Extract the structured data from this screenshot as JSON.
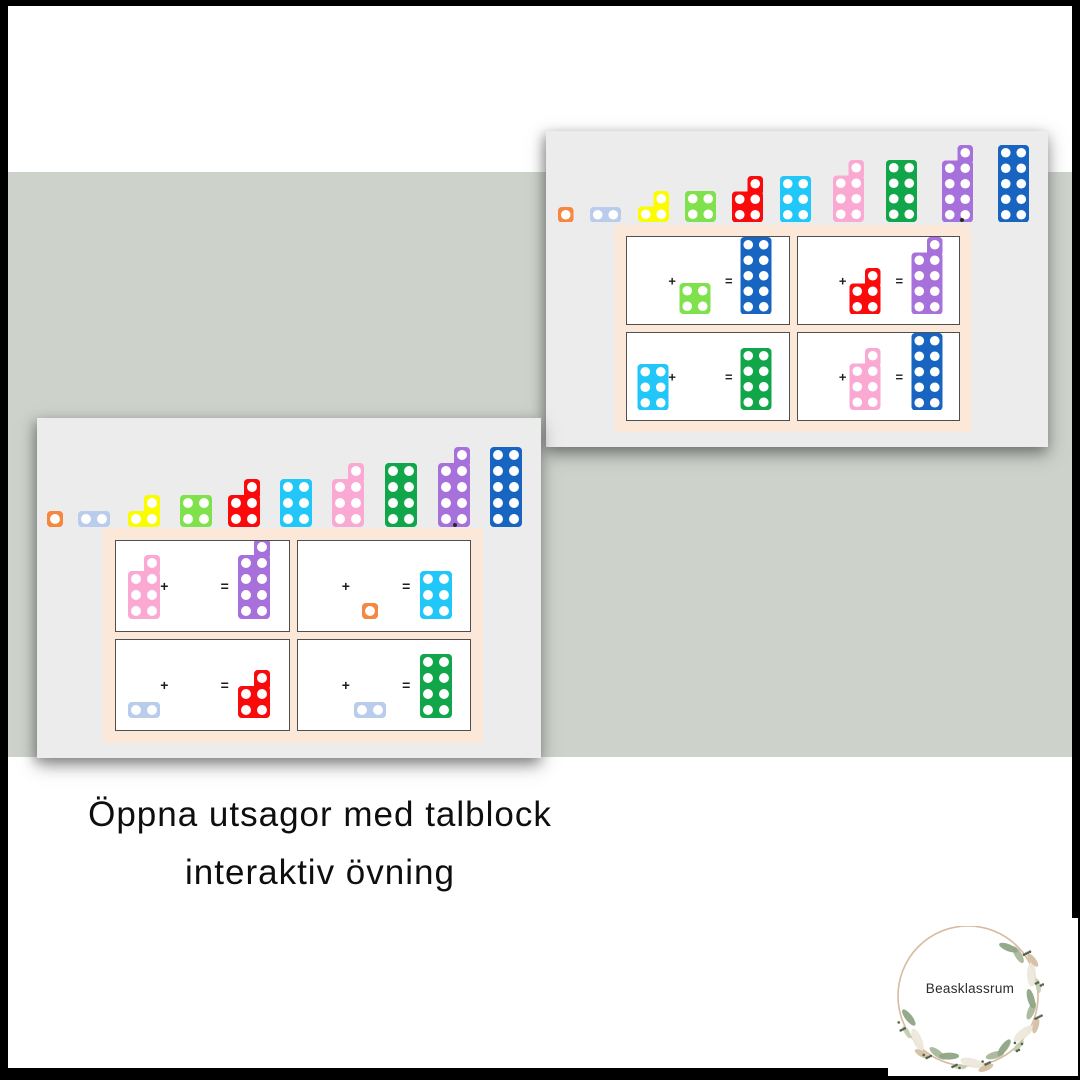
{
  "page": {
    "title_line1": "Öppna utsagor med talblock",
    "title_line2": "interaktiv övning"
  },
  "logo": {
    "text": "Beasklassrum"
  },
  "operators": {
    "plus": "+",
    "equals": "="
  },
  "palette": {
    "band_green": "#cdd3cb",
    "frame_black": "#000000",
    "screenshot_bg": "#ececec",
    "panel_peach": "#fbe8d9",
    "card_bg": "#ffffff",
    "card_border": "#4f4f4f",
    "hole_white": "#ffffff",
    "block_colors": {
      "1": "#f5873f",
      "2": "#b9ccec",
      "3": "#fcfc00",
      "4": "#7fe24d",
      "5": "#fa0a0a",
      "6": "#21c7f8",
      "7": "#faaad2",
      "8": "#12a64a",
      "9": "#a771db",
      "10": "#1865c1"
    }
  },
  "screenshots": [
    {
      "name": "slide-top-right",
      "row_blocks": [
        1,
        2,
        3,
        4,
        5,
        6,
        7,
        8,
        9,
        10
      ],
      "cards": [
        {
          "first": null,
          "second": 4,
          "result": 10
        },
        {
          "first": null,
          "second": 5,
          "result": 9
        },
        {
          "first": 6,
          "second": null,
          "result": 8
        },
        {
          "first": null,
          "second": 7,
          "result": 10
        }
      ]
    },
    {
      "name": "slide-bottom-left",
      "row_blocks": [
        1,
        2,
        3,
        4,
        5,
        6,
        7,
        8,
        9,
        10
      ],
      "cards": [
        {
          "first": 7,
          "second": null,
          "result": 9
        },
        {
          "first": null,
          "second": 1,
          "result": 6
        },
        {
          "first": 2,
          "second": null,
          "result": 5
        },
        {
          "first": null,
          "second": 2,
          "result": 8
        }
      ]
    }
  ]
}
